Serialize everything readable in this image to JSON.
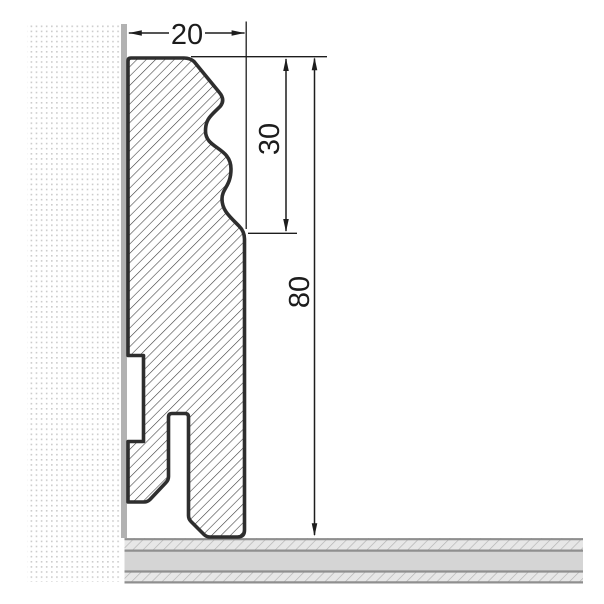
{
  "drawing": {
    "name": "skirting-board-profile-cross-section",
    "dimensions": {
      "width": {
        "label": "20"
      },
      "upper_profile_height": {
        "label": "30"
      },
      "total_height": {
        "label": "80"
      }
    },
    "colors": {
      "profile_outline": "#2e2e2e",
      "profile_hatch": "#3a3a3a",
      "wall_strip": "#b2b2b2",
      "wall_dot": "#cccccc",
      "floor_base": "#e7e7e7",
      "floor_mid_band": "#d5d5d5",
      "floor_hatch": "#b2b2b2",
      "floor_separator": "#8f8f8f",
      "dimension_ink": "#1d1d1d",
      "background": "#ffffff"
    }
  }
}
